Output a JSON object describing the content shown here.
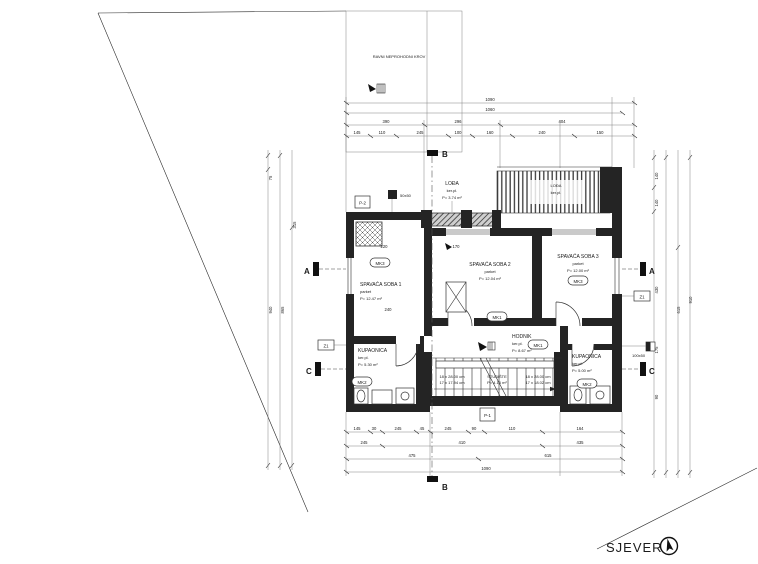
{
  "notes": {
    "roof": "RAVNI NEPROHODNI KROV",
    "north": "SJEVER"
  },
  "rooms": {
    "bed1": {
      "name": "SPAVAĆA SOBA 1",
      "floor": "parket",
      "area": "P= 12.47 m²"
    },
    "bed2": {
      "name": "SPAVAĆA SOBA 2",
      "floor": "parket",
      "area": "P= 12.04 m²"
    },
    "bed3": {
      "name": "SPAVAĆA SOBA 3",
      "floor": "parket",
      "area": "P= 12.00 m²"
    },
    "hall": {
      "name": "HODNIK",
      "floor": "ker.pl.",
      "area": "P= 8.67 m²"
    },
    "bath1": {
      "name": "KUPAONICA",
      "floor": "ker.pl.",
      "area": "P= 5.30 m²"
    },
    "bath2": {
      "name": "KUPAONICA",
      "floor": "ker.pl.",
      "area": "P= 5.00 m²"
    },
    "loggia": {
      "name": "LOĐA",
      "floor": "ker.pl.",
      "area": "P= 3.74 m²"
    },
    "terrace": {
      "name": "LOĐA",
      "floor": "ker.pl."
    }
  },
  "stairs": {
    "name": "STUBIŠTE",
    "area": "P= 4.16 m²",
    "left1": "18 x 28.00 cm",
    "left2": "17 x 17.94 cm",
    "right1": "18 x 28.00 cm",
    "right2": "17 x 18.02 cm"
  },
  "marks": {
    "mk1": "MK1",
    "mk2": "MK2",
    "mk3": "MK3",
    "z1": "Z1",
    "p1": "P-1",
    "p2": "P-2",
    "a": "A",
    "b": "B",
    "c": "C",
    "vent_small": "50x50",
    "vent_right": "100x50"
  },
  "dims": {
    "top": {
      "overall": "1090",
      "second": "1060",
      "row3": [
        "390",
        "296",
        "404"
      ],
      "row4": [
        "145",
        "110",
        "245",
        "100",
        "160",
        "240",
        "150"
      ]
    },
    "bottom": {
      "row1": [
        "145",
        "30",
        "245",
        "45",
        "245",
        "90",
        "110",
        "164"
      ],
      "row2": [
        "245",
        "410",
        "435"
      ],
      "row3": [
        "475",
        "615"
      ],
      "overall": "1090"
    },
    "left": [
      "75",
      "940",
      "865",
      "315"
    ],
    "right": [
      "140",
      "140",
      "910",
      "430",
      "615",
      "175",
      "90"
    ],
    "interior": [
      "220",
      "170",
      "240"
    ]
  }
}
